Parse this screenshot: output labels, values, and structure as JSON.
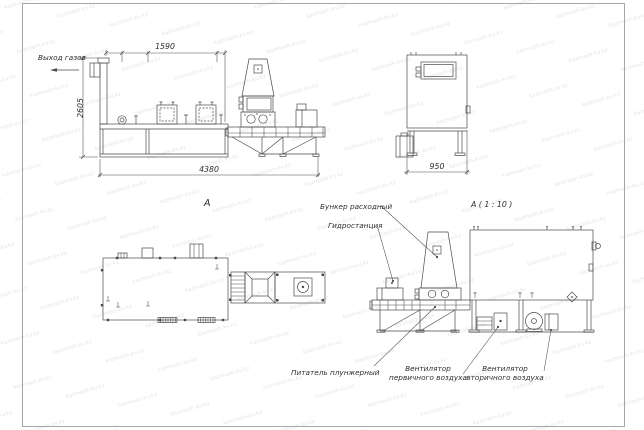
{
  "watermark": {
    "text": "kazmash-kv.kz"
  },
  "colors": {
    "background": "#ffffff",
    "line": "#4a4a4a",
    "text": "#2e2e2e",
    "frame": "#a6a6a6",
    "watermark": "#e0e4e9"
  },
  "views": {
    "side": {
      "gas_outlet_label": "Выход газов",
      "dim_top": "1590",
      "dim_height": "2605",
      "dim_total": "4380"
    },
    "end": {
      "dim_width": "950"
    },
    "plan": {
      "label": "А"
    },
    "detail": {
      "title": "А ( 1 : 10 )",
      "hopper": "Бункер расходный",
      "hydraulic": "Гидростанция",
      "feeder": "Питатель плунжерный",
      "primary_fan": {
        "line1": "Вентилятор",
        "line2": "первичного воздуха"
      },
      "secondary_fan": {
        "line1": "Вентилятор",
        "line2": "вторичного воздуха"
      }
    }
  }
}
